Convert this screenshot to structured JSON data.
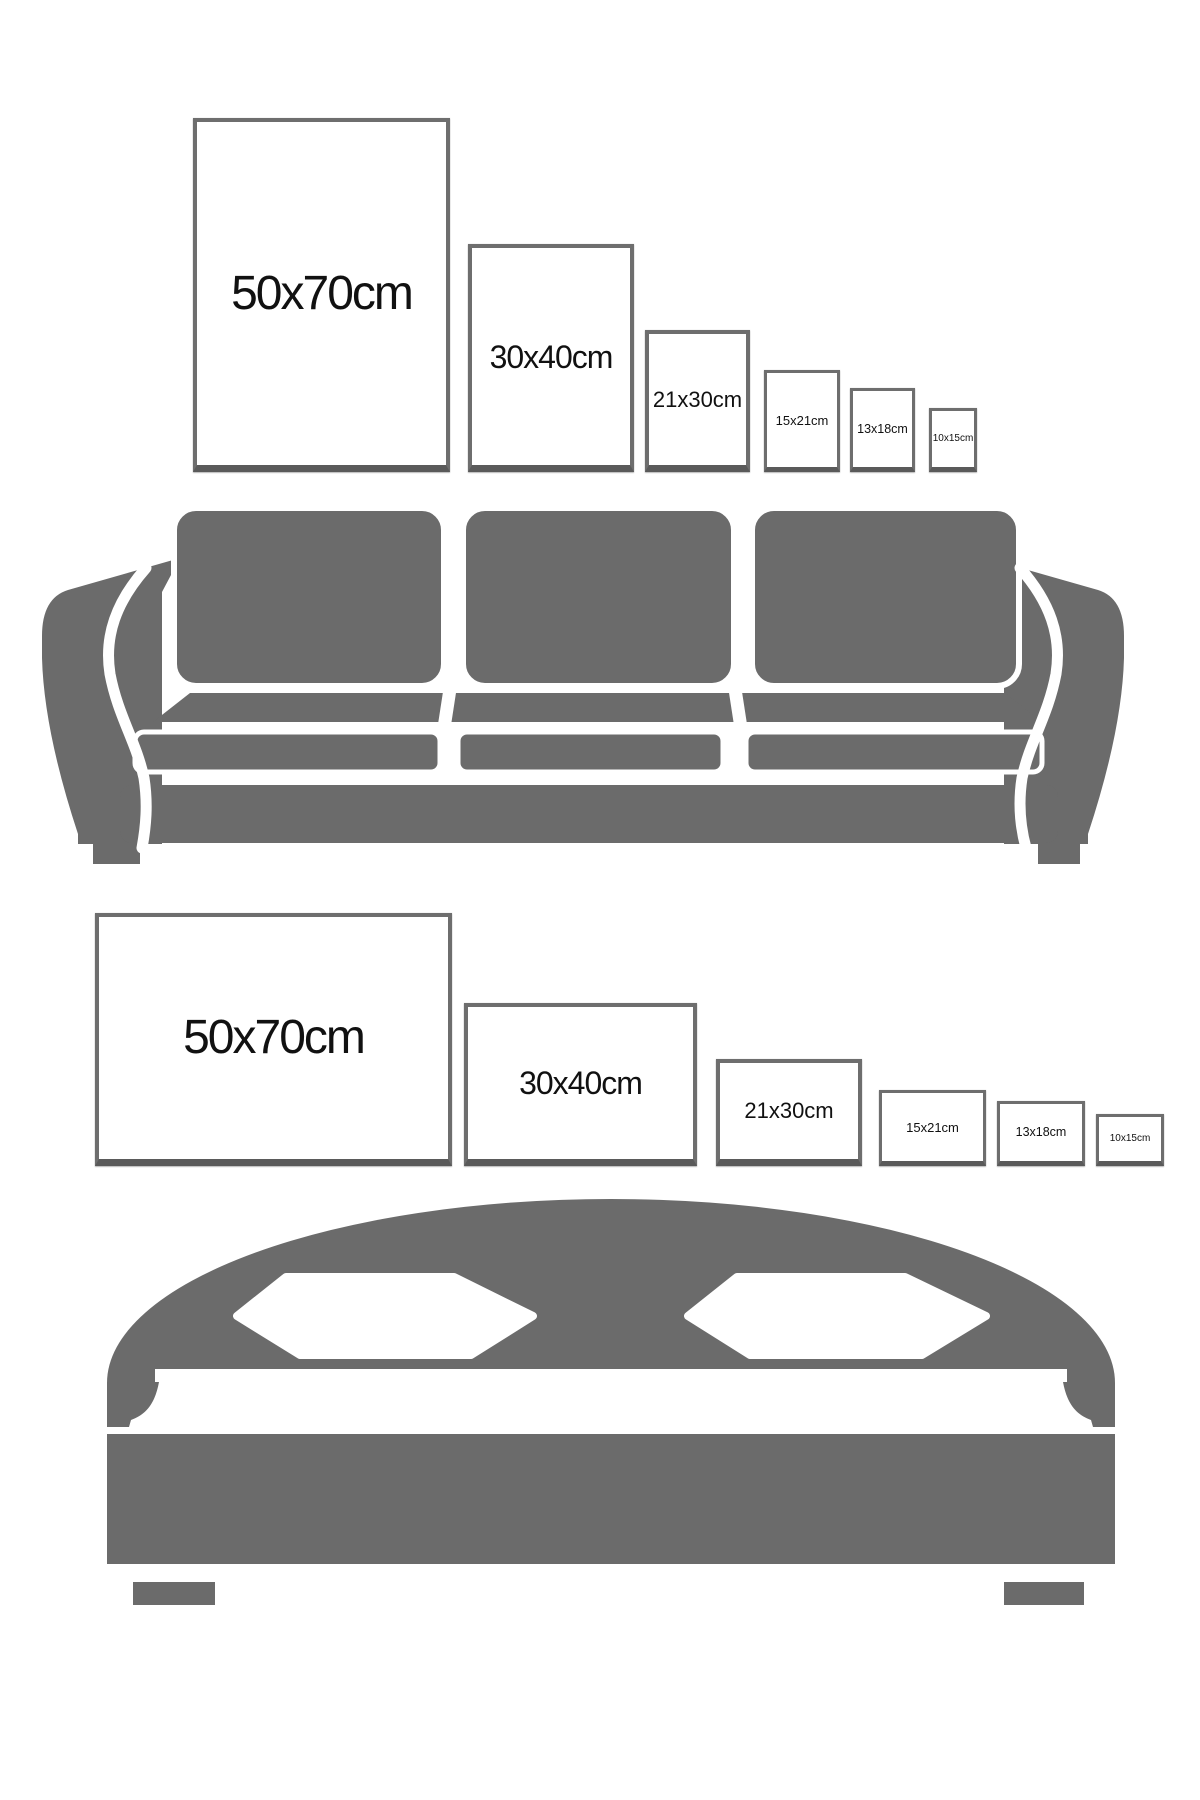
{
  "canvas": {
    "bg": "#ffffff",
    "furniture_gray": "#6b6b6b",
    "frame_border": "#6e6e6e",
    "frame_border_bottom": "#5a5a5a",
    "label_color": "#111111"
  },
  "sofa_wall": {
    "furniture": "sofa",
    "frames": [
      {
        "label": "50x70cm",
        "width_cm": 50,
        "height_cm": 70,
        "orientation": "portrait"
      },
      {
        "label": "30x40cm",
        "width_cm": 30,
        "height_cm": 40,
        "orientation": "portrait"
      },
      {
        "label": "21x30cm",
        "width_cm": 21,
        "height_cm": 30,
        "orientation": "portrait"
      },
      {
        "label": "15x21cm",
        "width_cm": 15,
        "height_cm": 21,
        "orientation": "portrait"
      },
      {
        "label": "13x18cm",
        "width_cm": 13,
        "height_cm": 18,
        "orientation": "portrait"
      },
      {
        "label": "10x15cm",
        "width_cm": 10,
        "height_cm": 15,
        "orientation": "portrait"
      }
    ]
  },
  "bed_wall": {
    "furniture": "bed",
    "frames": [
      {
        "label": "50x70cm",
        "width_cm": 50,
        "height_cm": 70,
        "orientation": "landscape"
      },
      {
        "label": "30x40cm",
        "width_cm": 30,
        "height_cm": 40,
        "orientation": "landscape"
      },
      {
        "label": "21x30cm",
        "width_cm": 21,
        "height_cm": 30,
        "orientation": "landscape"
      },
      {
        "label": "15x21cm",
        "width_cm": 15,
        "height_cm": 21,
        "orientation": "landscape"
      },
      {
        "label": "13x18cm",
        "width_cm": 13,
        "height_cm": 18,
        "orientation": "landscape"
      },
      {
        "label": "10x15cm",
        "width_cm": 10,
        "height_cm": 15,
        "orientation": "landscape"
      }
    ]
  }
}
